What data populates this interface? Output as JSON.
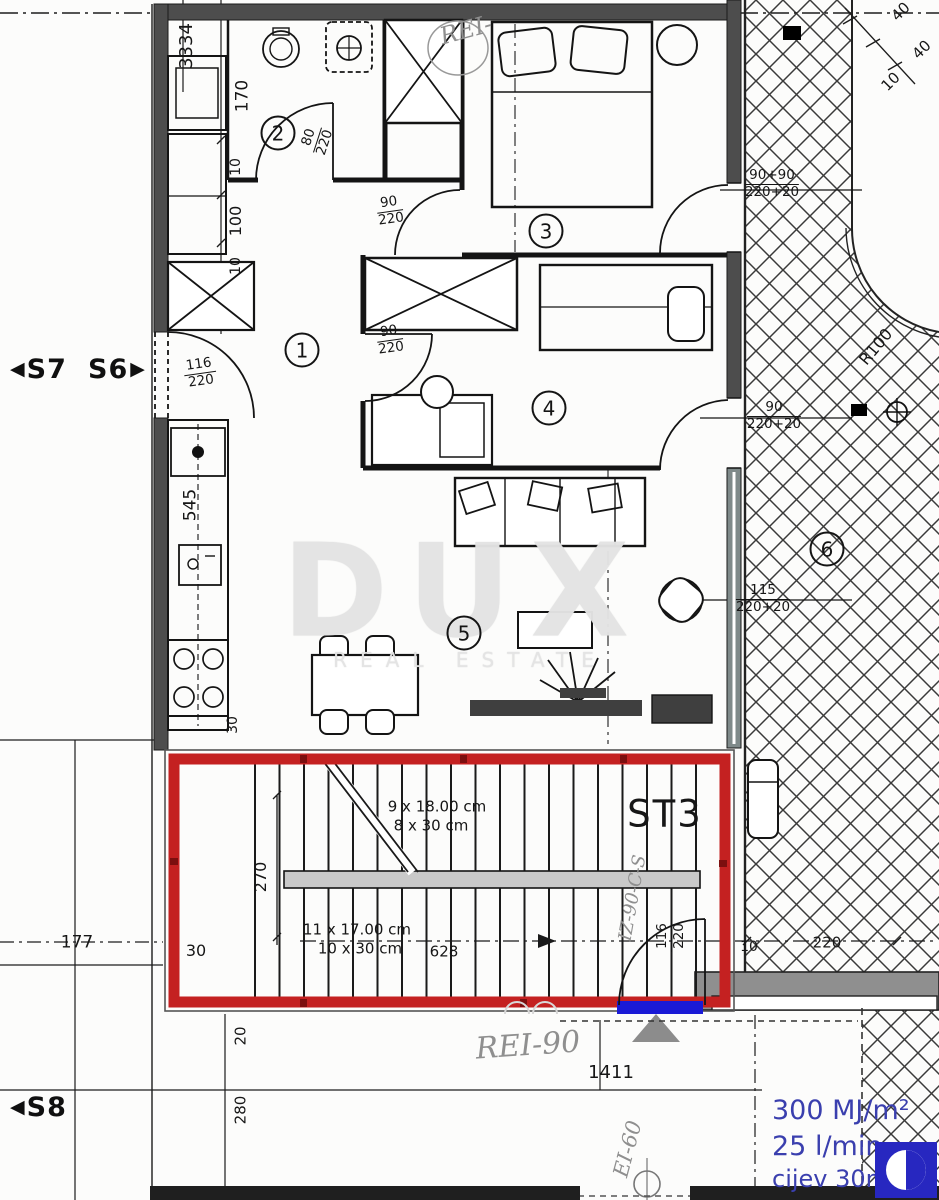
{
  "markers": {
    "s7": {
      "arrow": "◀",
      "label": "S7"
    },
    "s6": {
      "label": "S6",
      "arrow": "▶"
    },
    "s8": {
      "arrow": "◀",
      "label": "S8"
    }
  },
  "rooms": [
    "1",
    "2",
    "3",
    "4",
    "5",
    "6"
  ],
  "stairs": {
    "name": "ST3",
    "upper_line1": "9 x 18.00 cm",
    "upper_line2": "8 x 30 cm",
    "lower_line1": "11 x 17.00 cm",
    "lower_line2": "10 x 30 cm"
  },
  "dims": [
    "3334",
    "170",
    "10",
    "100",
    "10",
    "545",
    "30",
    "270",
    "30",
    "177",
    "628",
    "20",
    "280",
    "1411",
    "10",
    "220",
    "40",
    "40",
    "10",
    "R100"
  ],
  "doors": [
    {
      "num": "80",
      "den": "220"
    },
    {
      "num": "90",
      "den": "220"
    },
    {
      "num": "90",
      "den": "220"
    },
    {
      "num": "116",
      "den": "220"
    },
    {
      "num": "116",
      "den": "220"
    },
    {
      "num": "90+90",
      "den": "220+20"
    },
    {
      "num": "90",
      "den": "220+20"
    },
    {
      "num": "115",
      "den": "220+20"
    }
  ],
  "annotations": {
    "rei_top": "REI-",
    "rei_90": "REI-90",
    "ei_60": "EI-60",
    "iz": "IZ-90-C-S"
  },
  "fire": {
    "energy": "300 MJ/m²",
    "flow": "25 l/min",
    "pipe": "cijev 30m"
  },
  "watermark": {
    "brand": "DUX",
    "tagline": "REAL ESTATE"
  },
  "colors": {
    "highlight_red": "#c42121",
    "marker_blue": "#1a1ad6",
    "text_blue": "#3a3fae",
    "wall_gray": "#4d4d4d"
  }
}
